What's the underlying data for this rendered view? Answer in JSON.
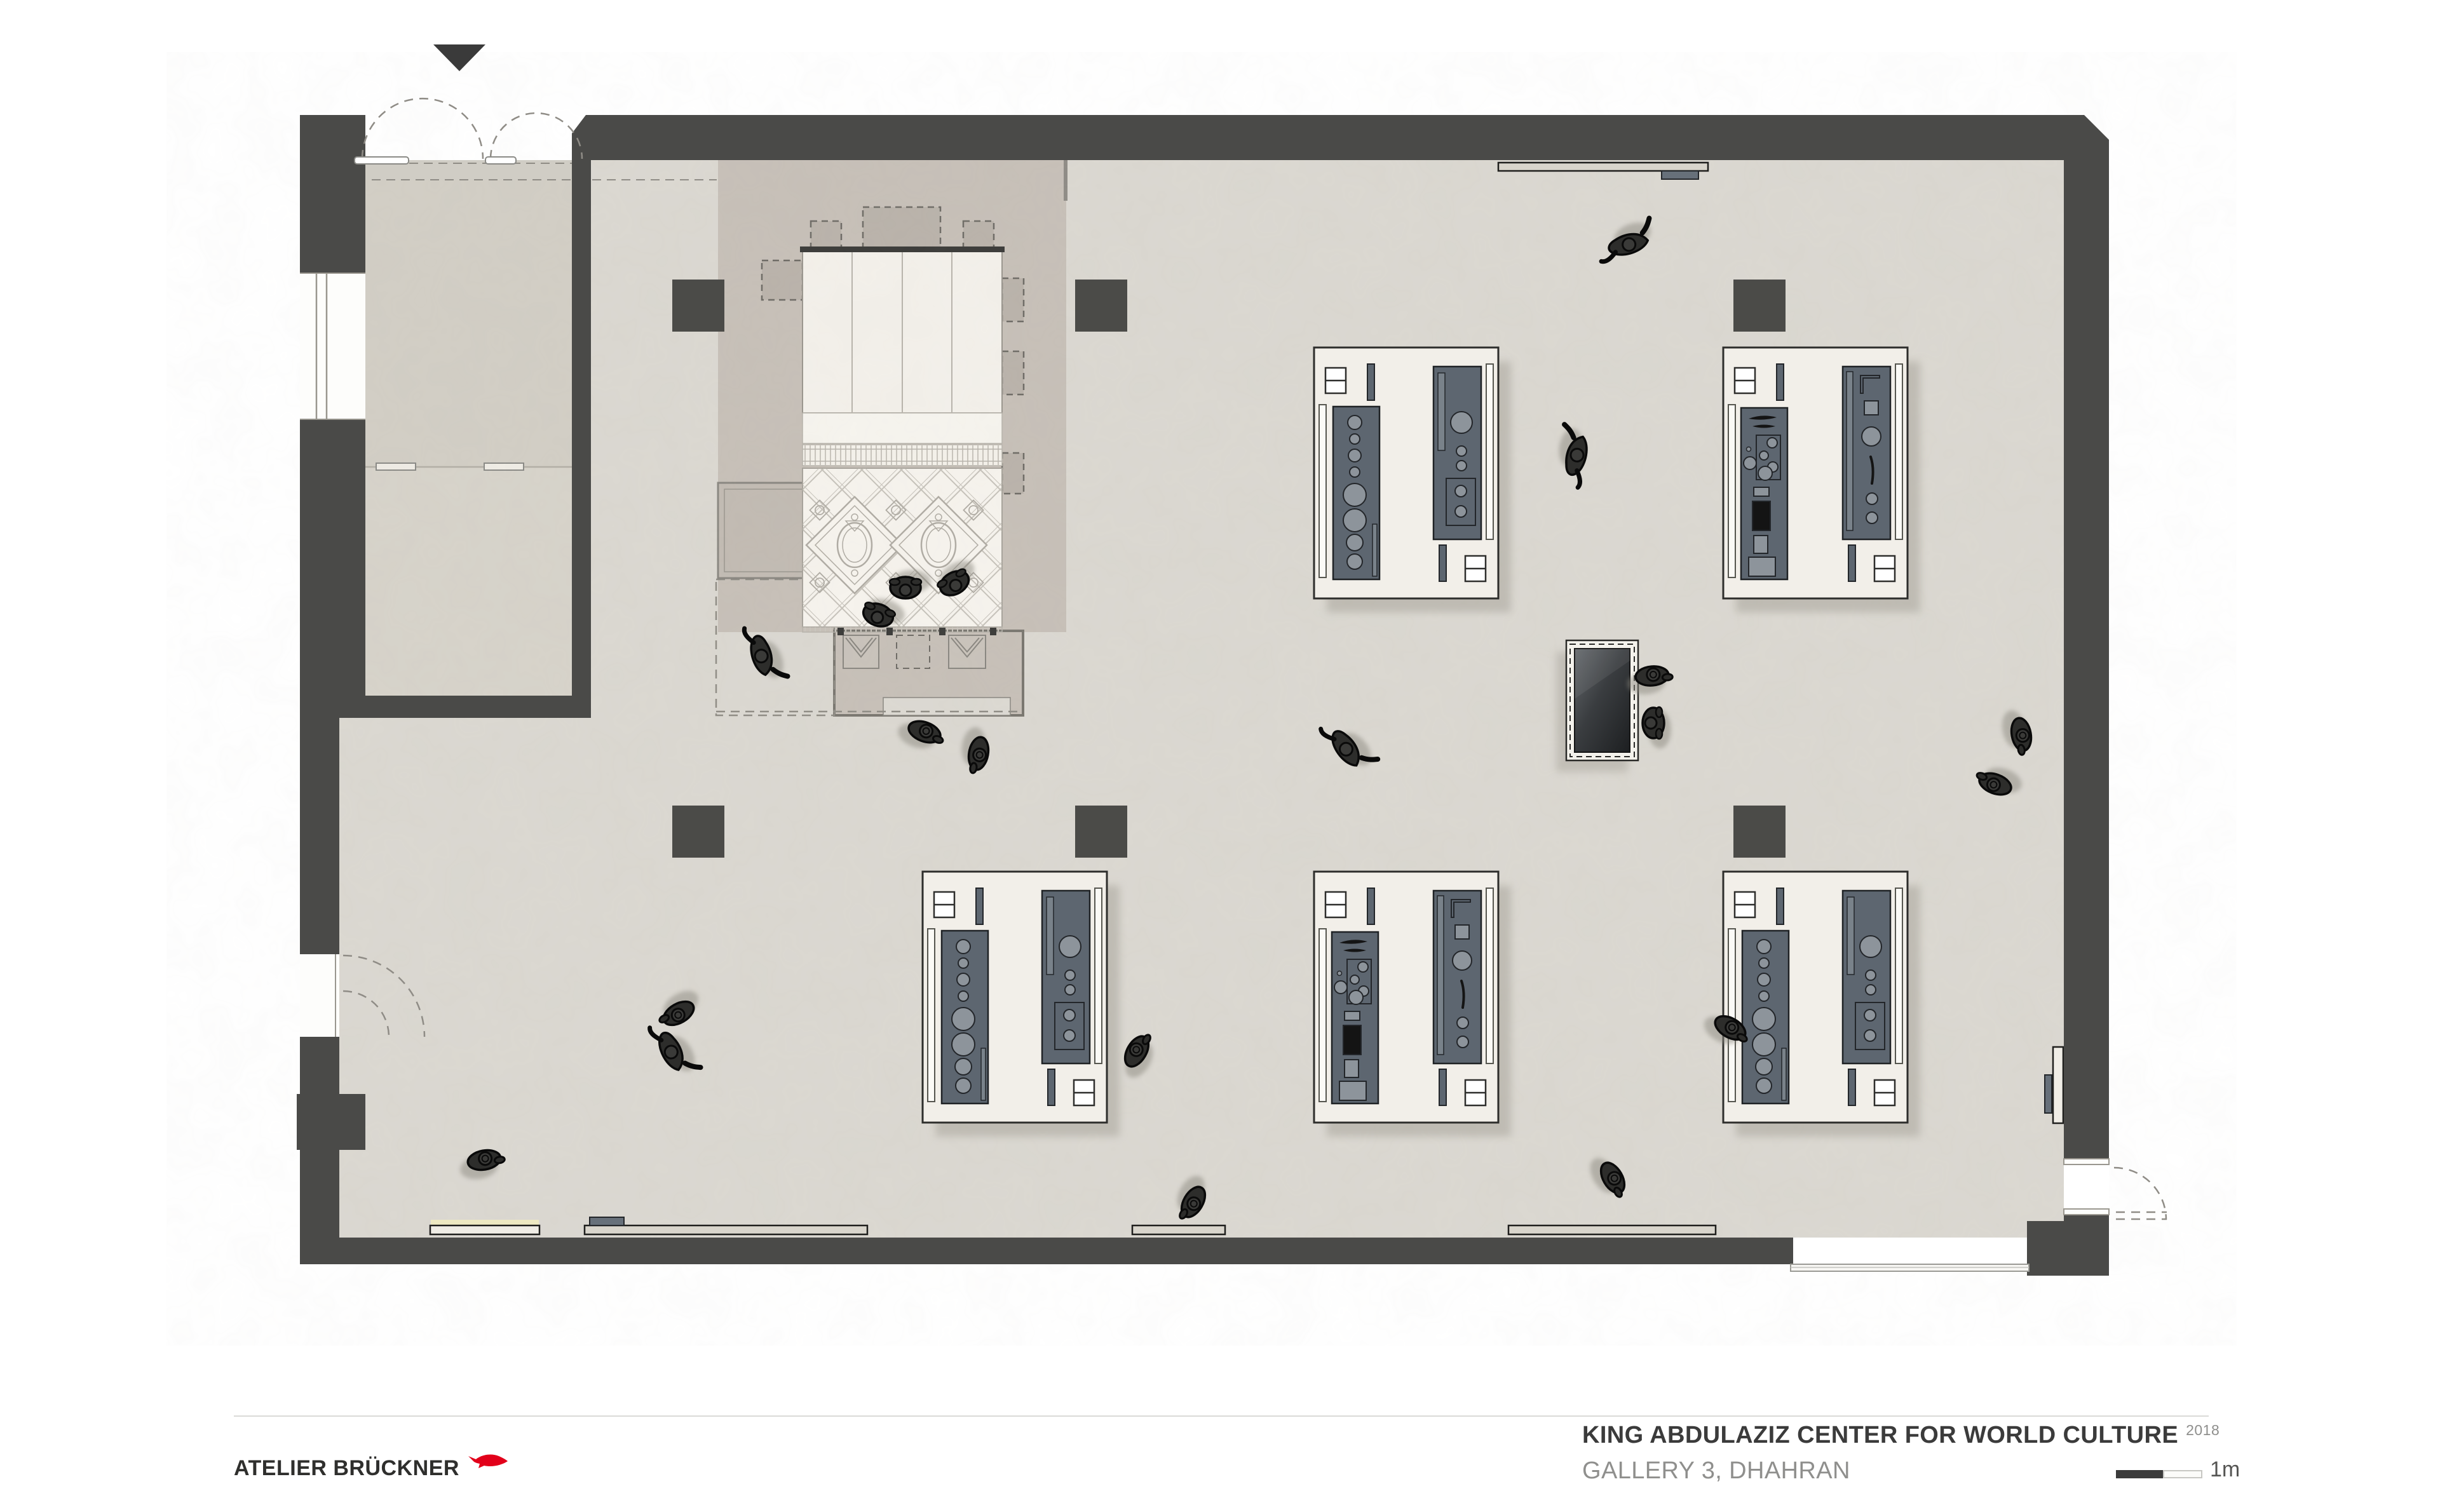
{
  "drawing": {
    "type": "architectural-floor-plan",
    "colors": {
      "wall": "#4a4a48",
      "gallery_floor": "#dbd8d1",
      "vestibule_floor": "#d2cec5",
      "platform_floor": "#c7c0b8",
      "carpet": "#f6f3ed",
      "table_top": "#f2efe9",
      "display_panel": "#5d6670",
      "visitor_figure": "#2d2d2b",
      "logo_accent": "#e2001a"
    },
    "elements": {
      "exhibit_tables": 5,
      "structural_columns": 6,
      "visitor_figures": 20,
      "media_wall": 1,
      "majlis_carpet_exhibit": 1,
      "entrance_doors": 2
    }
  },
  "footer": {
    "logo_text": "ATELIER BRÜCKNER",
    "logo_mark": "fish-icon",
    "logo_accent_color": "#e2001a",
    "project_title": "KING ABDULAZIZ CENTER FOR WORLD CULTURE",
    "project_year": "2018",
    "project_subtitle": "GALLERY 3, DHAHRAN",
    "scale_label": "1m"
  }
}
